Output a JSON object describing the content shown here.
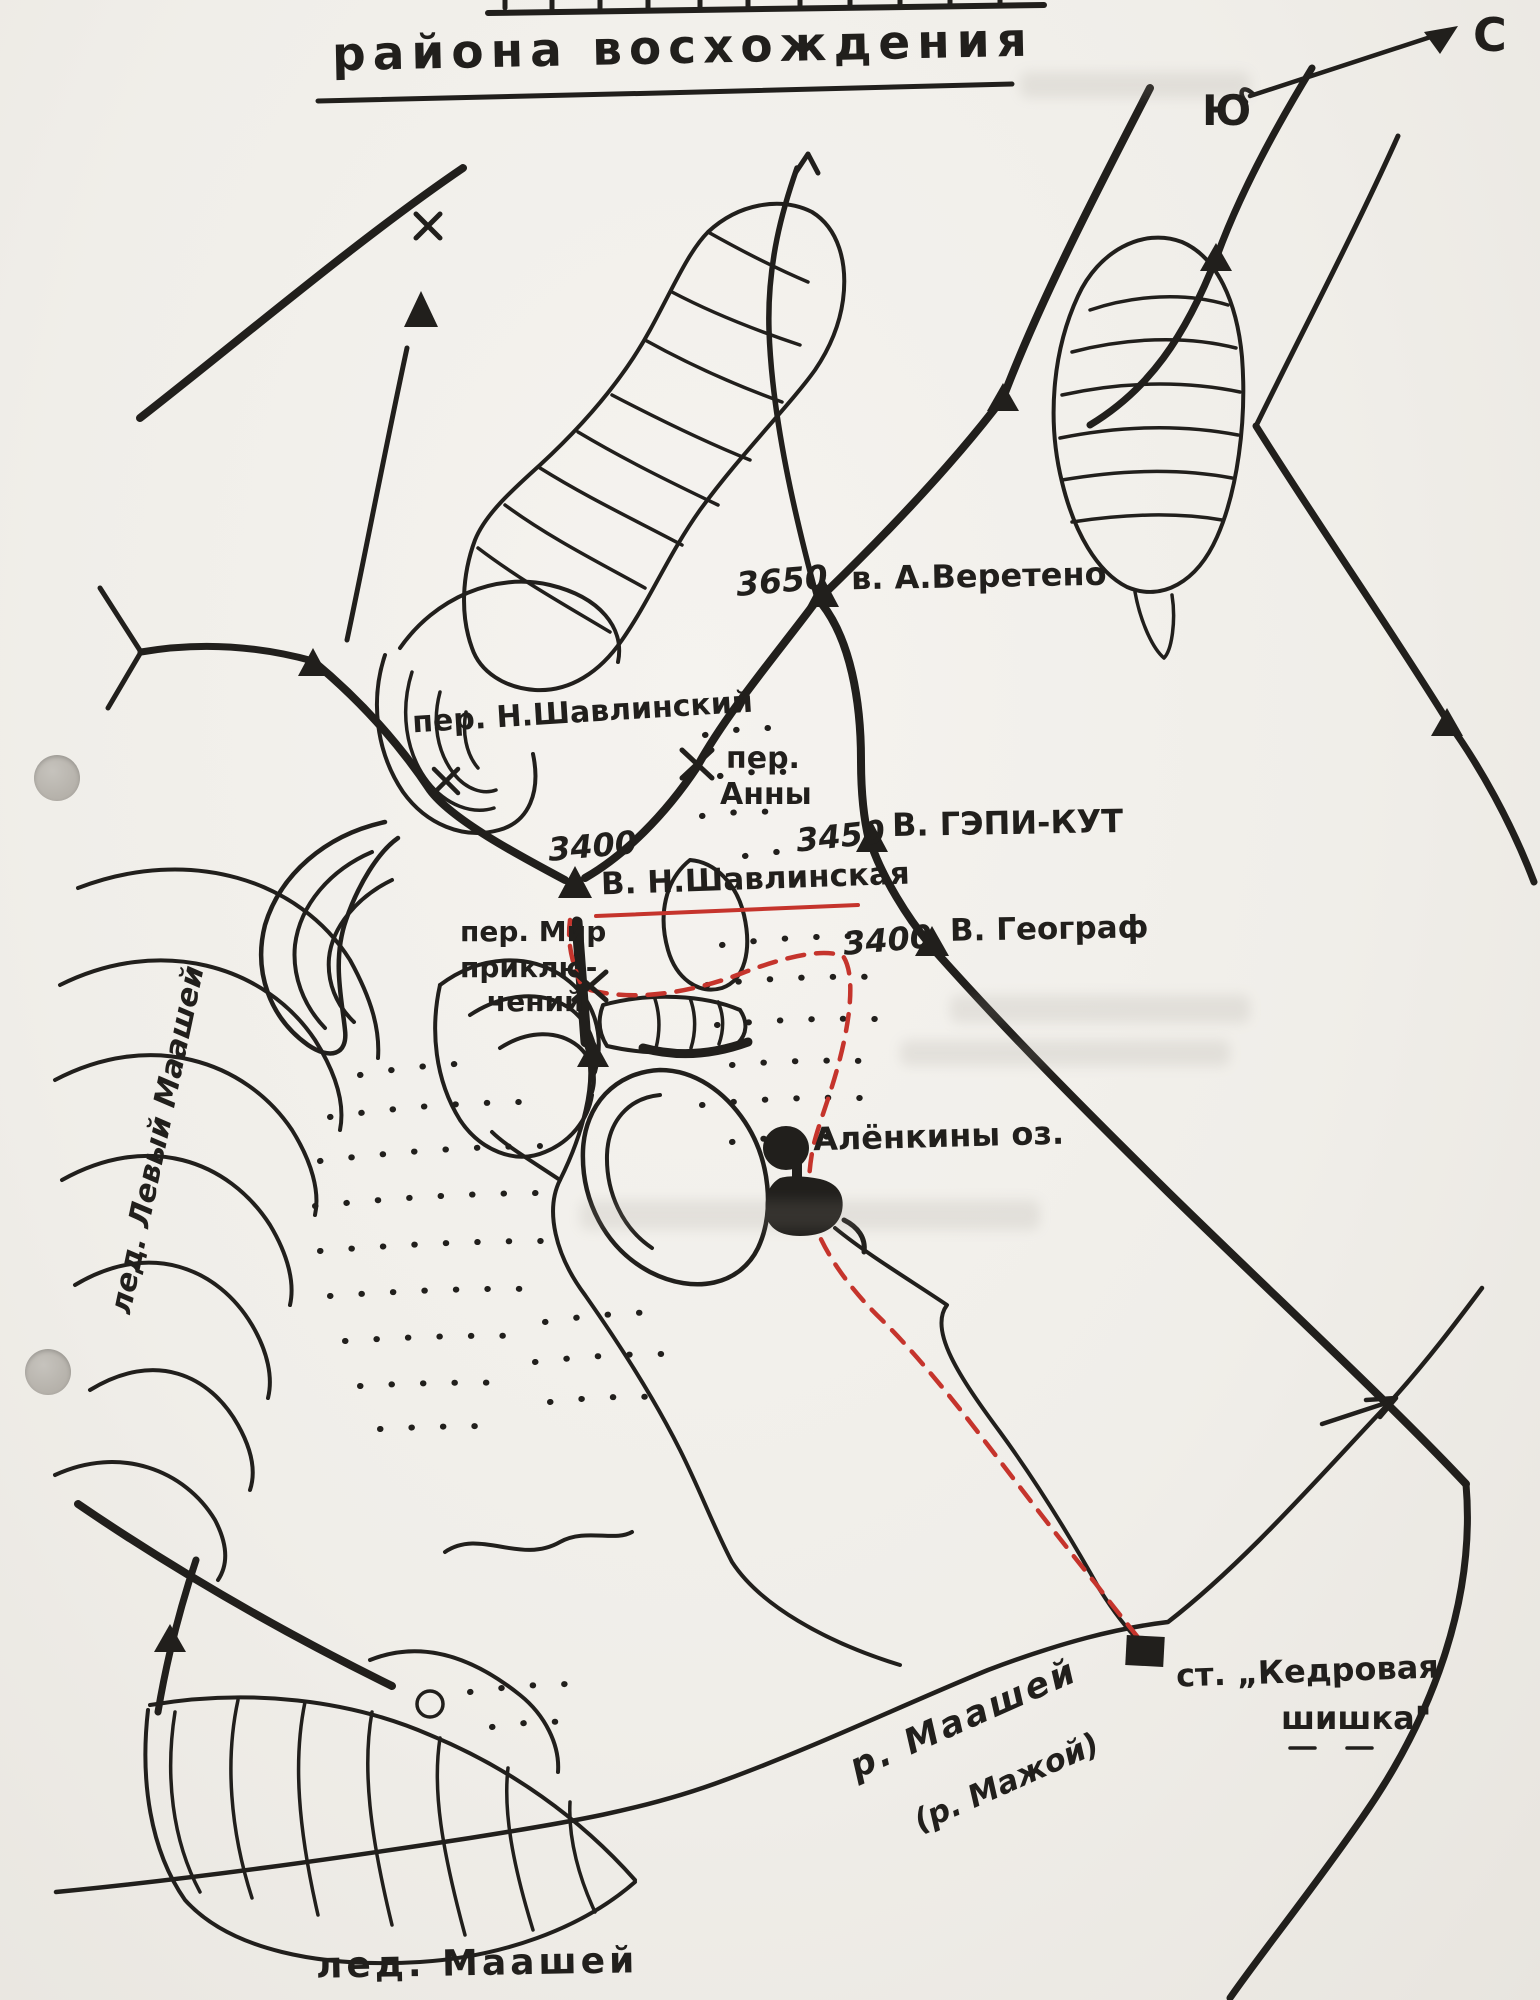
{
  "page": {
    "kind": "hand-drawn mountaineering sketch map (scan)",
    "ink_color": "#211f1c",
    "route_color": "#c5342c",
    "paper_color": "#f0eee9"
  },
  "labels": {
    "title": "района восхождения",
    "compass_s": "Ю",
    "compass_n": "С",
    "peak_vereteno_elev": "3650",
    "peak_vereteno": "в. А.Веретено",
    "pass_shavlinsky": "пер. Н.Шавлинский",
    "pass_anny_1": "пер.",
    "pass_anny_2": "Анны",
    "peak_gepikut_elev": "3450",
    "peak_gepikut": "В. ГЭПИ-КУТ",
    "peak_shavlinskaya_elev": "3400",
    "peak_shavlinskaya": "В. Н.Шавлинская",
    "pass_mir_1": "пер. Мир",
    "pass_mir_2": "приклю-",
    "pass_mir_3": "чений",
    "peak_geograf_elev": "3400",
    "peak_geograf": "В. Географ",
    "lakes": "Алёнкины оз.",
    "glacier_left": "лед. Левый Маашей",
    "station_1": "ст. „Кедровая",
    "station_2": "шишка\"",
    "river_1": "р. Маашей",
    "river_2": "(р. Мажой)",
    "glacier_maashey": "лед. Маашей"
  }
}
